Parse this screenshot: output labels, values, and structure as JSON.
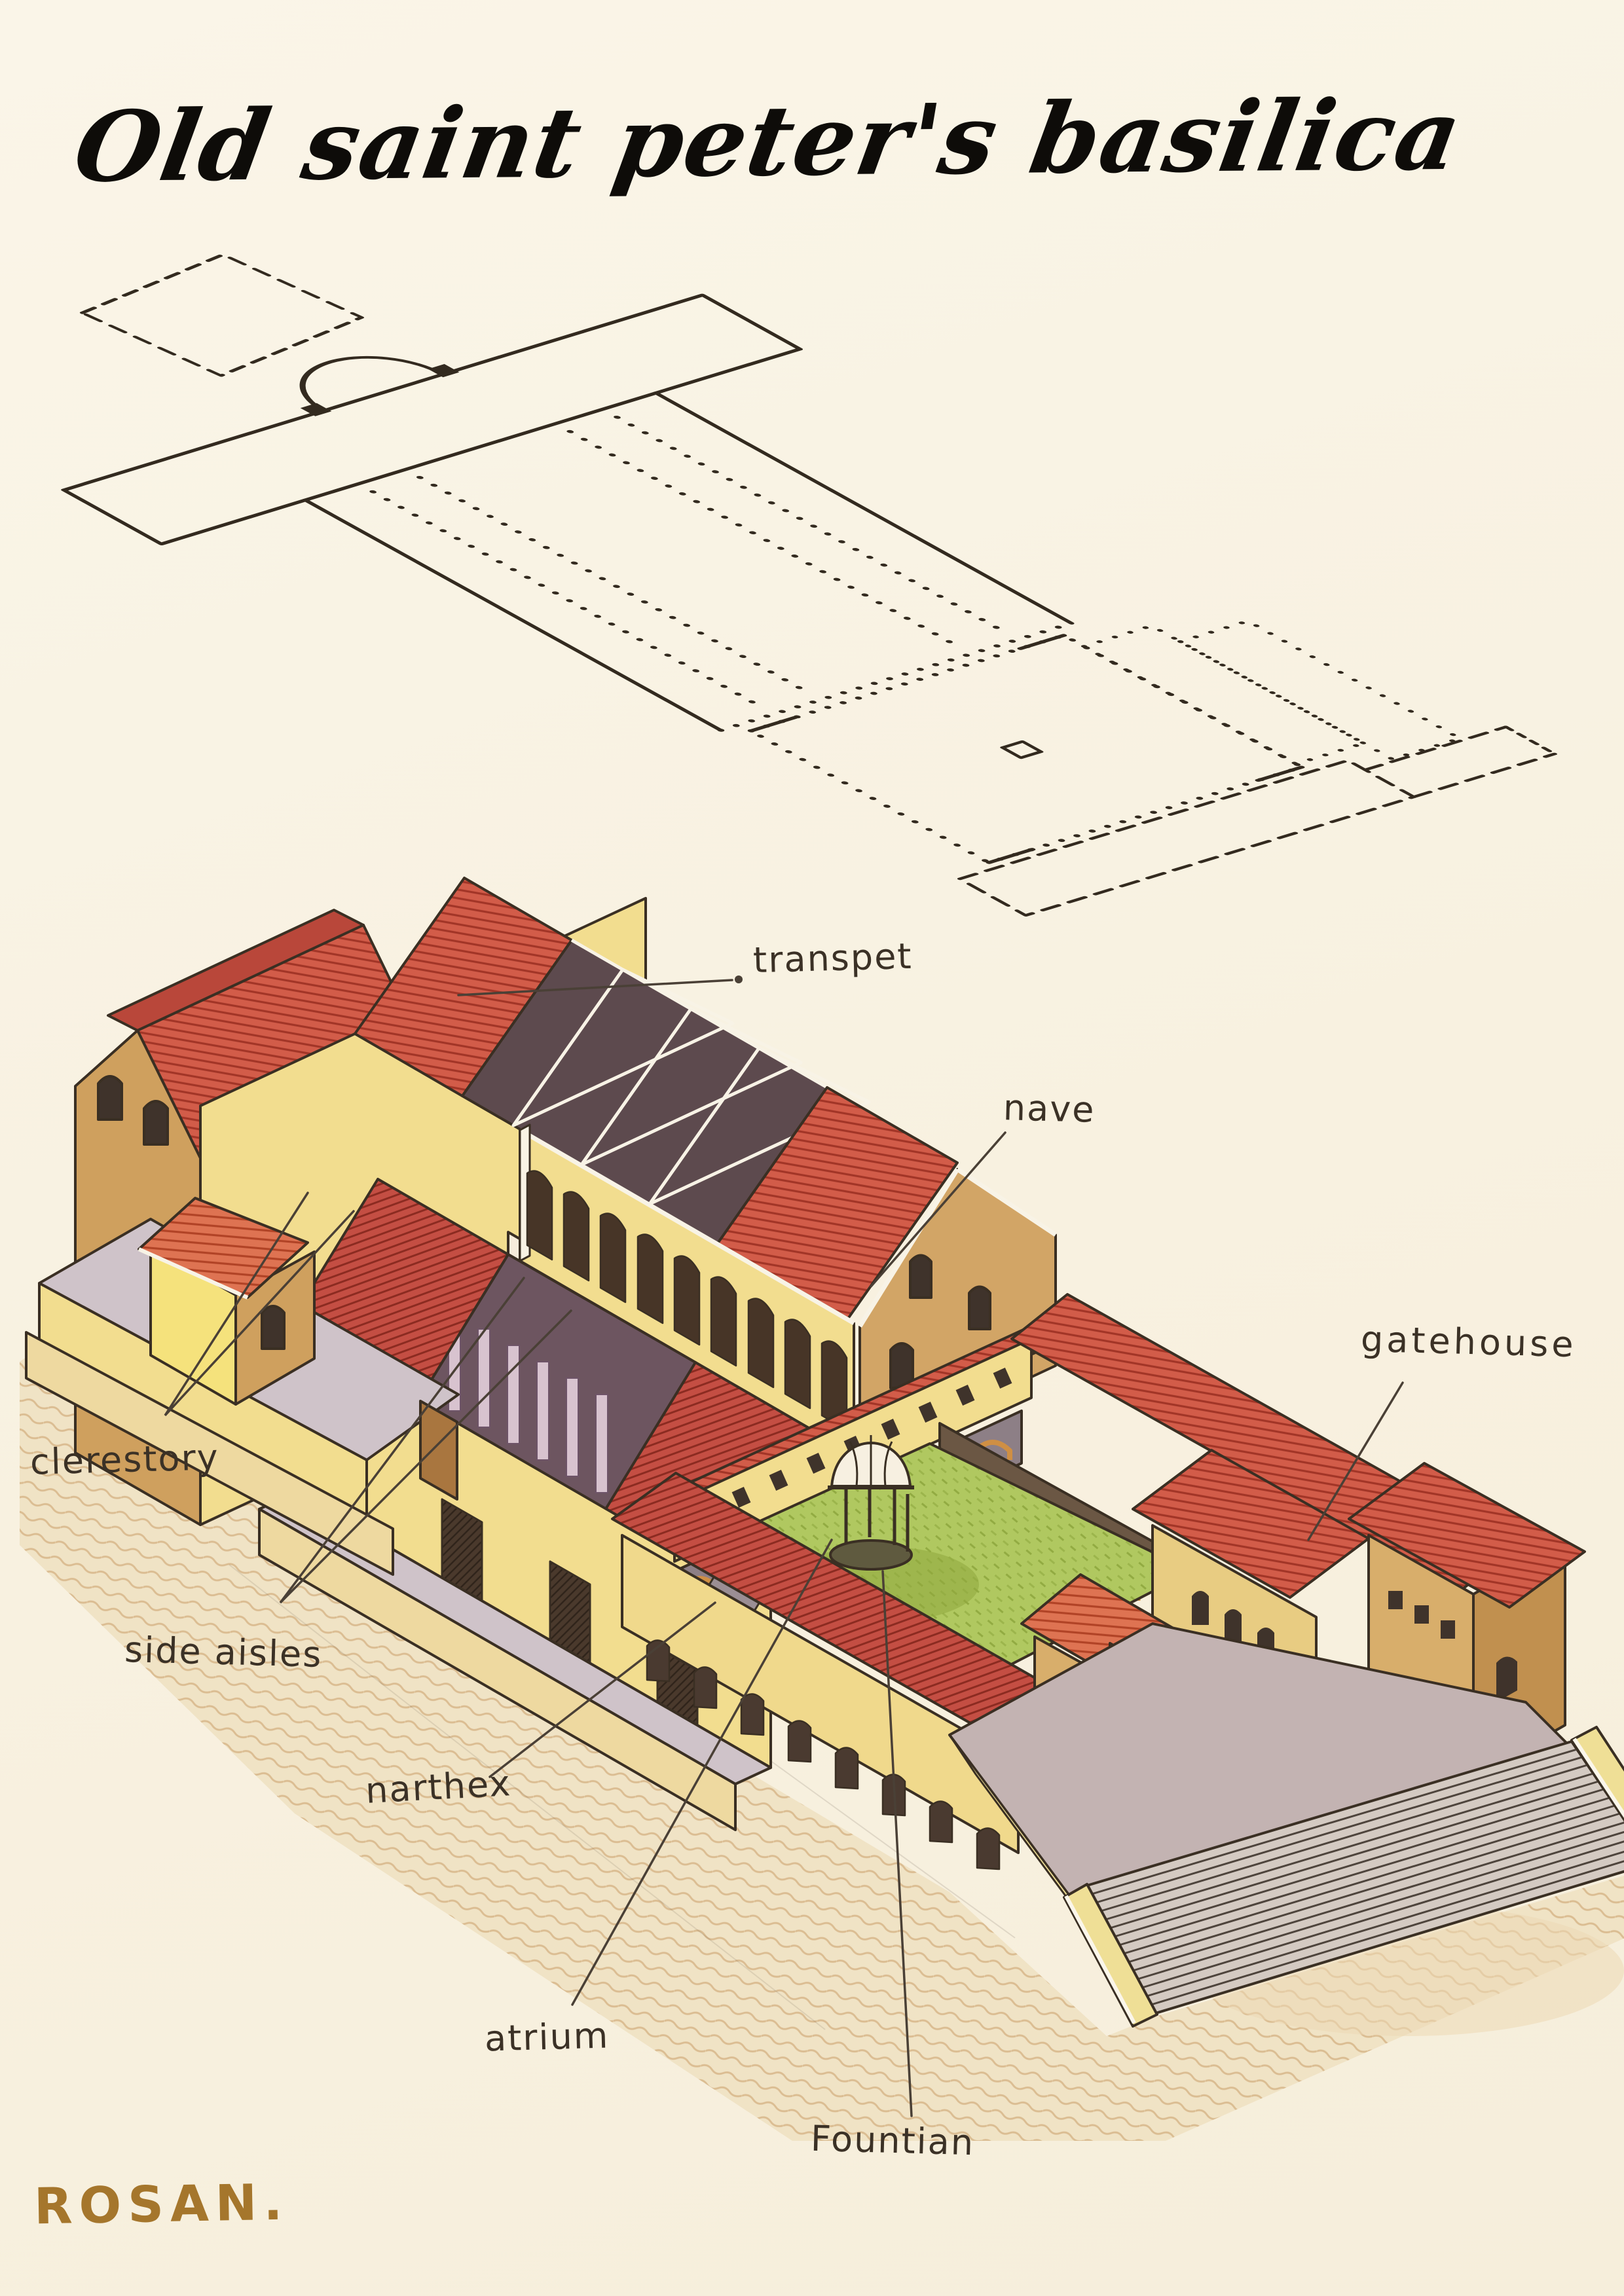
{
  "title": "Old saint peter's basilica",
  "signature": "ROSAN.",
  "drawing": {
    "subject": "Old Saint Peter's Basilica",
    "views": [
      "dotted floor plan",
      "cutaway isometric reconstruction sketch"
    ]
  },
  "labels": {
    "transpet": "transpet",
    "nave": "nave",
    "gatehouse": "gatehouse",
    "clerestory": "clerestory",
    "side_aisles": "side aisles",
    "narthex": "narthex",
    "atrium": "atrium",
    "fountain": "Fountian"
  },
  "colors": {
    "paper": "#f8f1e0",
    "ink": "#3a2f23",
    "roof_red": "#d25c49",
    "roof_crimson": "#c44e43",
    "wall_yellow": "#f2dd8f",
    "wall_tan": "#cfa05e",
    "lawn_green": "#b0c860",
    "sand": "#e6cda1",
    "stone_gray": "#c3b3b2",
    "signature_gold": "#a5762c"
  }
}
